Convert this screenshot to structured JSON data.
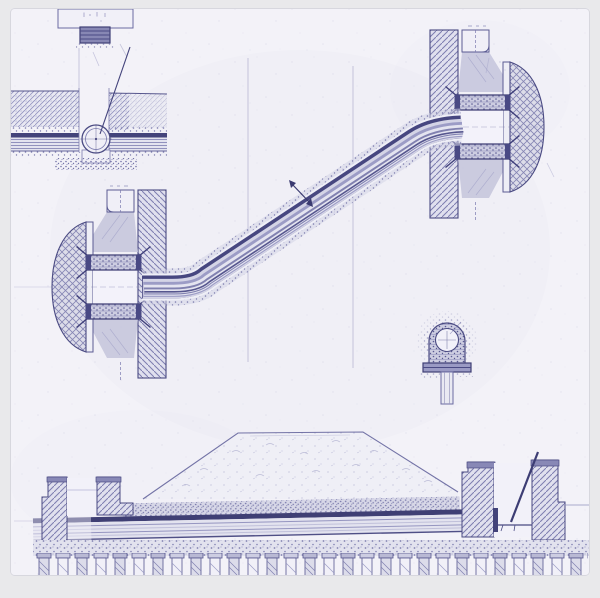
{
  "figure": {
    "kind": "technical-blueprint-drawing",
    "description": "Hand-drawn engineering blueprint in indigo ink on aged paper: an inclined encased pipeline connecting two masonry wall penetrations with bellmouths, a buried pipe with valve pit (upper left), a culvert plan fragment at the top edge, a small pipe cross-section on a pile, and a longitudinal section of a pipeline under an embankment carried on a pile row.",
    "visible_text": []
  },
  "palette": {
    "canvas_bg": "#e9e9eb",
    "paper": "#f3f2f8",
    "paper_edge": "#d7d7de",
    "ink_dark": "#3e3e74",
    "ink": "#56568e",
    "ink_mid": "#7a7aae",
    "ink_light": "#9a9ac4",
    "wash_masonry": "#e0e0ee",
    "wash_bell": "#dcdce9",
    "wash_flange": "#cdcde1",
    "wash_shade": "#c6c6dd",
    "wash_mound": "#efeff6",
    "pipe_dark": "#474780",
    "pipe_fill": "#e3e3ef"
  },
  "components": {
    "top_culvert": {
      "label": "culvert plan fragment (cut by top edge)"
    },
    "buried_pipe": {
      "label": "buried pipe with circular valve in pit, section"
    },
    "left_penetration": {
      "label": "left wall penetration with bellmouth and bolted flanges"
    },
    "right_penetration": {
      "label": "right wall penetration with bellmouth and bolted flanges"
    },
    "inclined_pipe": {
      "label": "inclined pipeline in stippled encasement"
    },
    "flow_mark": {
      "label": "section/flow mark crossing pipe"
    },
    "pipe_cross_section": {
      "label": "pipe cross-section in arched saddle on pile"
    },
    "embankment": {
      "label": "embankment crossing: mound, pipe, chambers, gravel bed, pile row"
    }
  }
}
